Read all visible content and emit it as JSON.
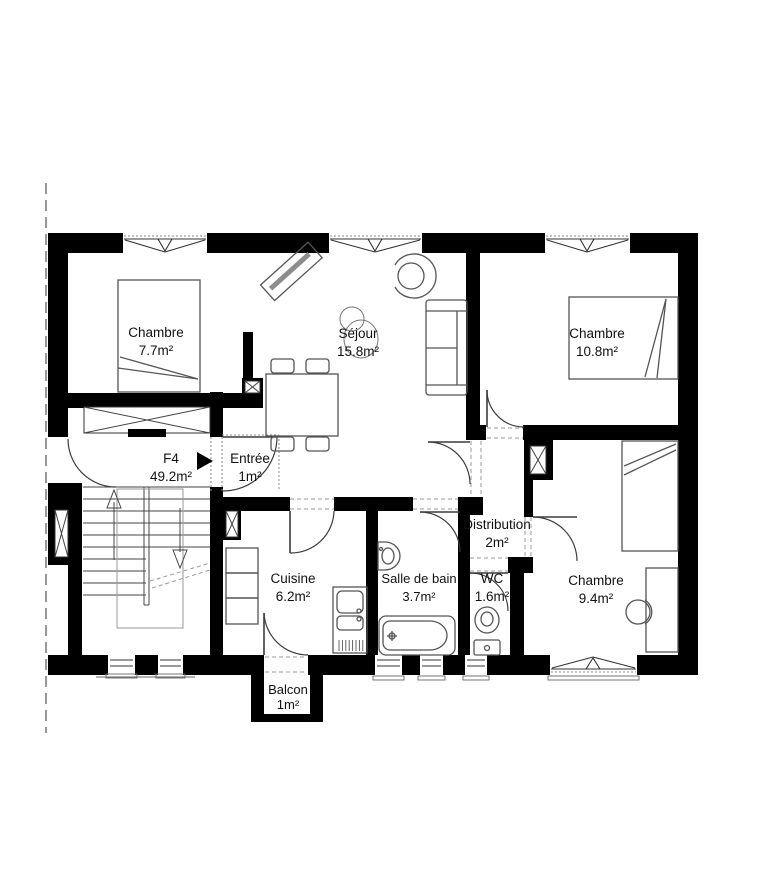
{
  "plan": {
    "unit": {
      "code": "F4",
      "area": "49.2m²"
    },
    "rooms": [
      {
        "id": "chambre-1",
        "name": "Chambre",
        "area": "7.7m²"
      },
      {
        "id": "sejour",
        "name": "Séjour",
        "area": "15.8m²"
      },
      {
        "id": "chambre-2",
        "name": "Chambre",
        "area": "10.8m²"
      },
      {
        "id": "entree",
        "name": "Entrée",
        "area": "1m²"
      },
      {
        "id": "cuisine",
        "name": "Cuisine",
        "area": "6.2m²"
      },
      {
        "id": "salle-de-bain",
        "name": "Salle de bain",
        "area": "3.7m²"
      },
      {
        "id": "wc",
        "name": "WC",
        "area": "1.6m²"
      },
      {
        "id": "distribution",
        "name": "Distribution",
        "area": "2m²"
      },
      {
        "id": "chambre-3",
        "name": "Chambre",
        "area": "9.4m²"
      },
      {
        "id": "balcon",
        "name": "Balcon",
        "area": "1m²"
      }
    ],
    "colors": {
      "wall": "#000000",
      "background": "#ffffff",
      "line": "#444444"
    }
  }
}
